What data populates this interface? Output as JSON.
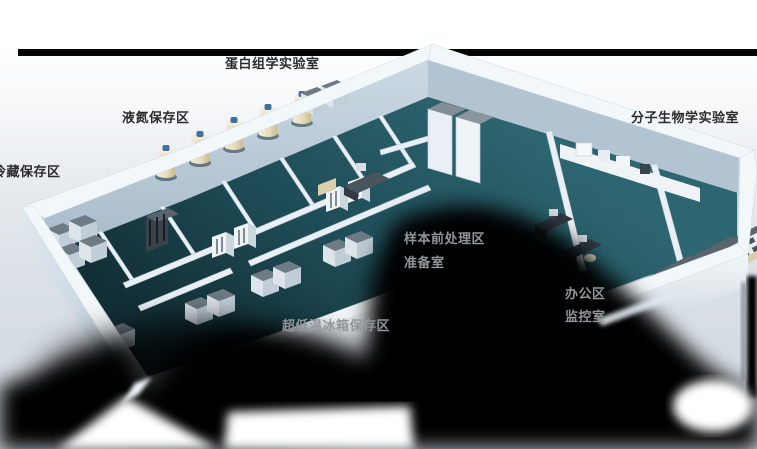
{
  "scene": "3d-laboratory-floorplan",
  "labels": {
    "proteomics_lab": "蛋白组学实验室",
    "ln2_storage": "液氮保存区",
    "cold_storage": "冷藏保存区",
    "molecular_biology_lab": "分子生物学实验室",
    "sample_pretreatment": "样本前处理区",
    "prep_room": "准备室",
    "office_area": "办公区",
    "monitoring_room": "监控室",
    "ult_freezer_storage": "超低温冰箱保存区"
  },
  "colors": {
    "background": "#ffffff",
    "top_bar": "#050505",
    "floor_teal": "#1f4e58",
    "wall_white": "#eef4f8",
    "wall_shade": "#aabdcb",
    "shadow_black": "#000000",
    "tank_body": "#e9e0c6",
    "tank_cap": "#40709f",
    "equipment_gray": "#6e7b85",
    "bench_counter": "#5a646e",
    "label_dark": "#2a2c2d",
    "label_light": "#90969a"
  }
}
